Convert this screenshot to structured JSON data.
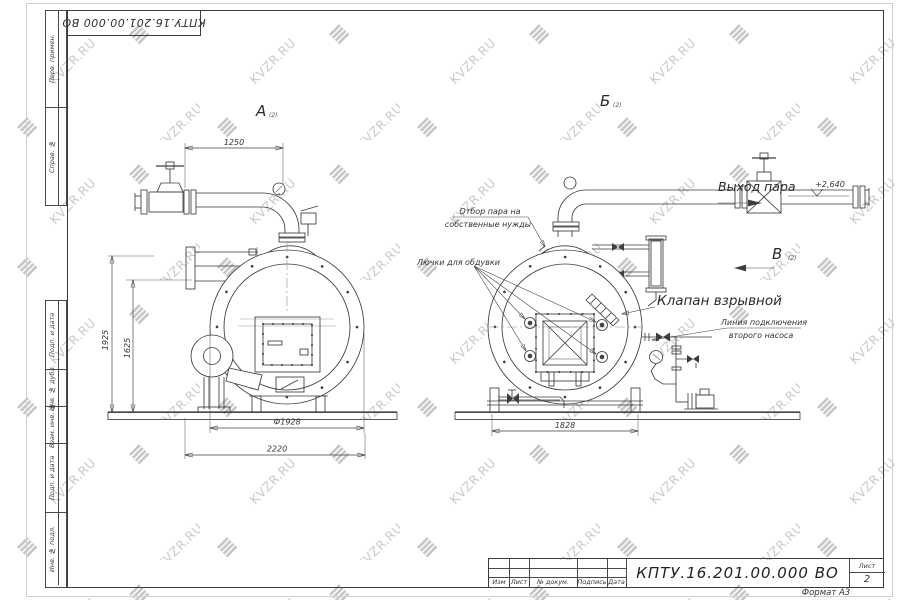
{
  "watermark": {
    "text": "KVZR.RU"
  },
  "stamp": {
    "designation_top": "КПТУ.16.201.00.000 ВО"
  },
  "side_columns": {
    "top": [
      "Перв. примен.",
      "Справ. №"
    ],
    "bottom": [
      "Подп. и дата",
      "Инв. № дубл.",
      "Взам. инв. №",
      "Подп. и дата",
      "Инв. № подл."
    ]
  },
  "title_block": {
    "designation": "КПТУ.16.201.00.000  ВО",
    "cols": [
      "Изм",
      "Лист",
      "№ докум.",
      "Подпись",
      "Дата"
    ],
    "sheet_label": "Лист",
    "sheet_number": "2",
    "format_label": "Формат А3"
  },
  "views": {
    "a": "А",
    "b": "Б",
    "v": "В",
    "ref": "(2)"
  },
  "labels": {
    "steam_out": "Выход пара",
    "elevation": "+2,640",
    "own_needs_line1": "Отбор пара на",
    "own_needs_line2": "собственные нужды",
    "blow_hatches": "Лючки для обдувки",
    "explosion_valve": "Клапан взрывной",
    "second_pump_line1": "Линия подключения",
    "second_pump_line2": "второго насоса"
  },
  "dims": {
    "width_top": "1250",
    "height_total": "1925",
    "height_axis": "1625",
    "diameter": "Ф1928",
    "length_total": "2220",
    "width_rear": "1828"
  }
}
